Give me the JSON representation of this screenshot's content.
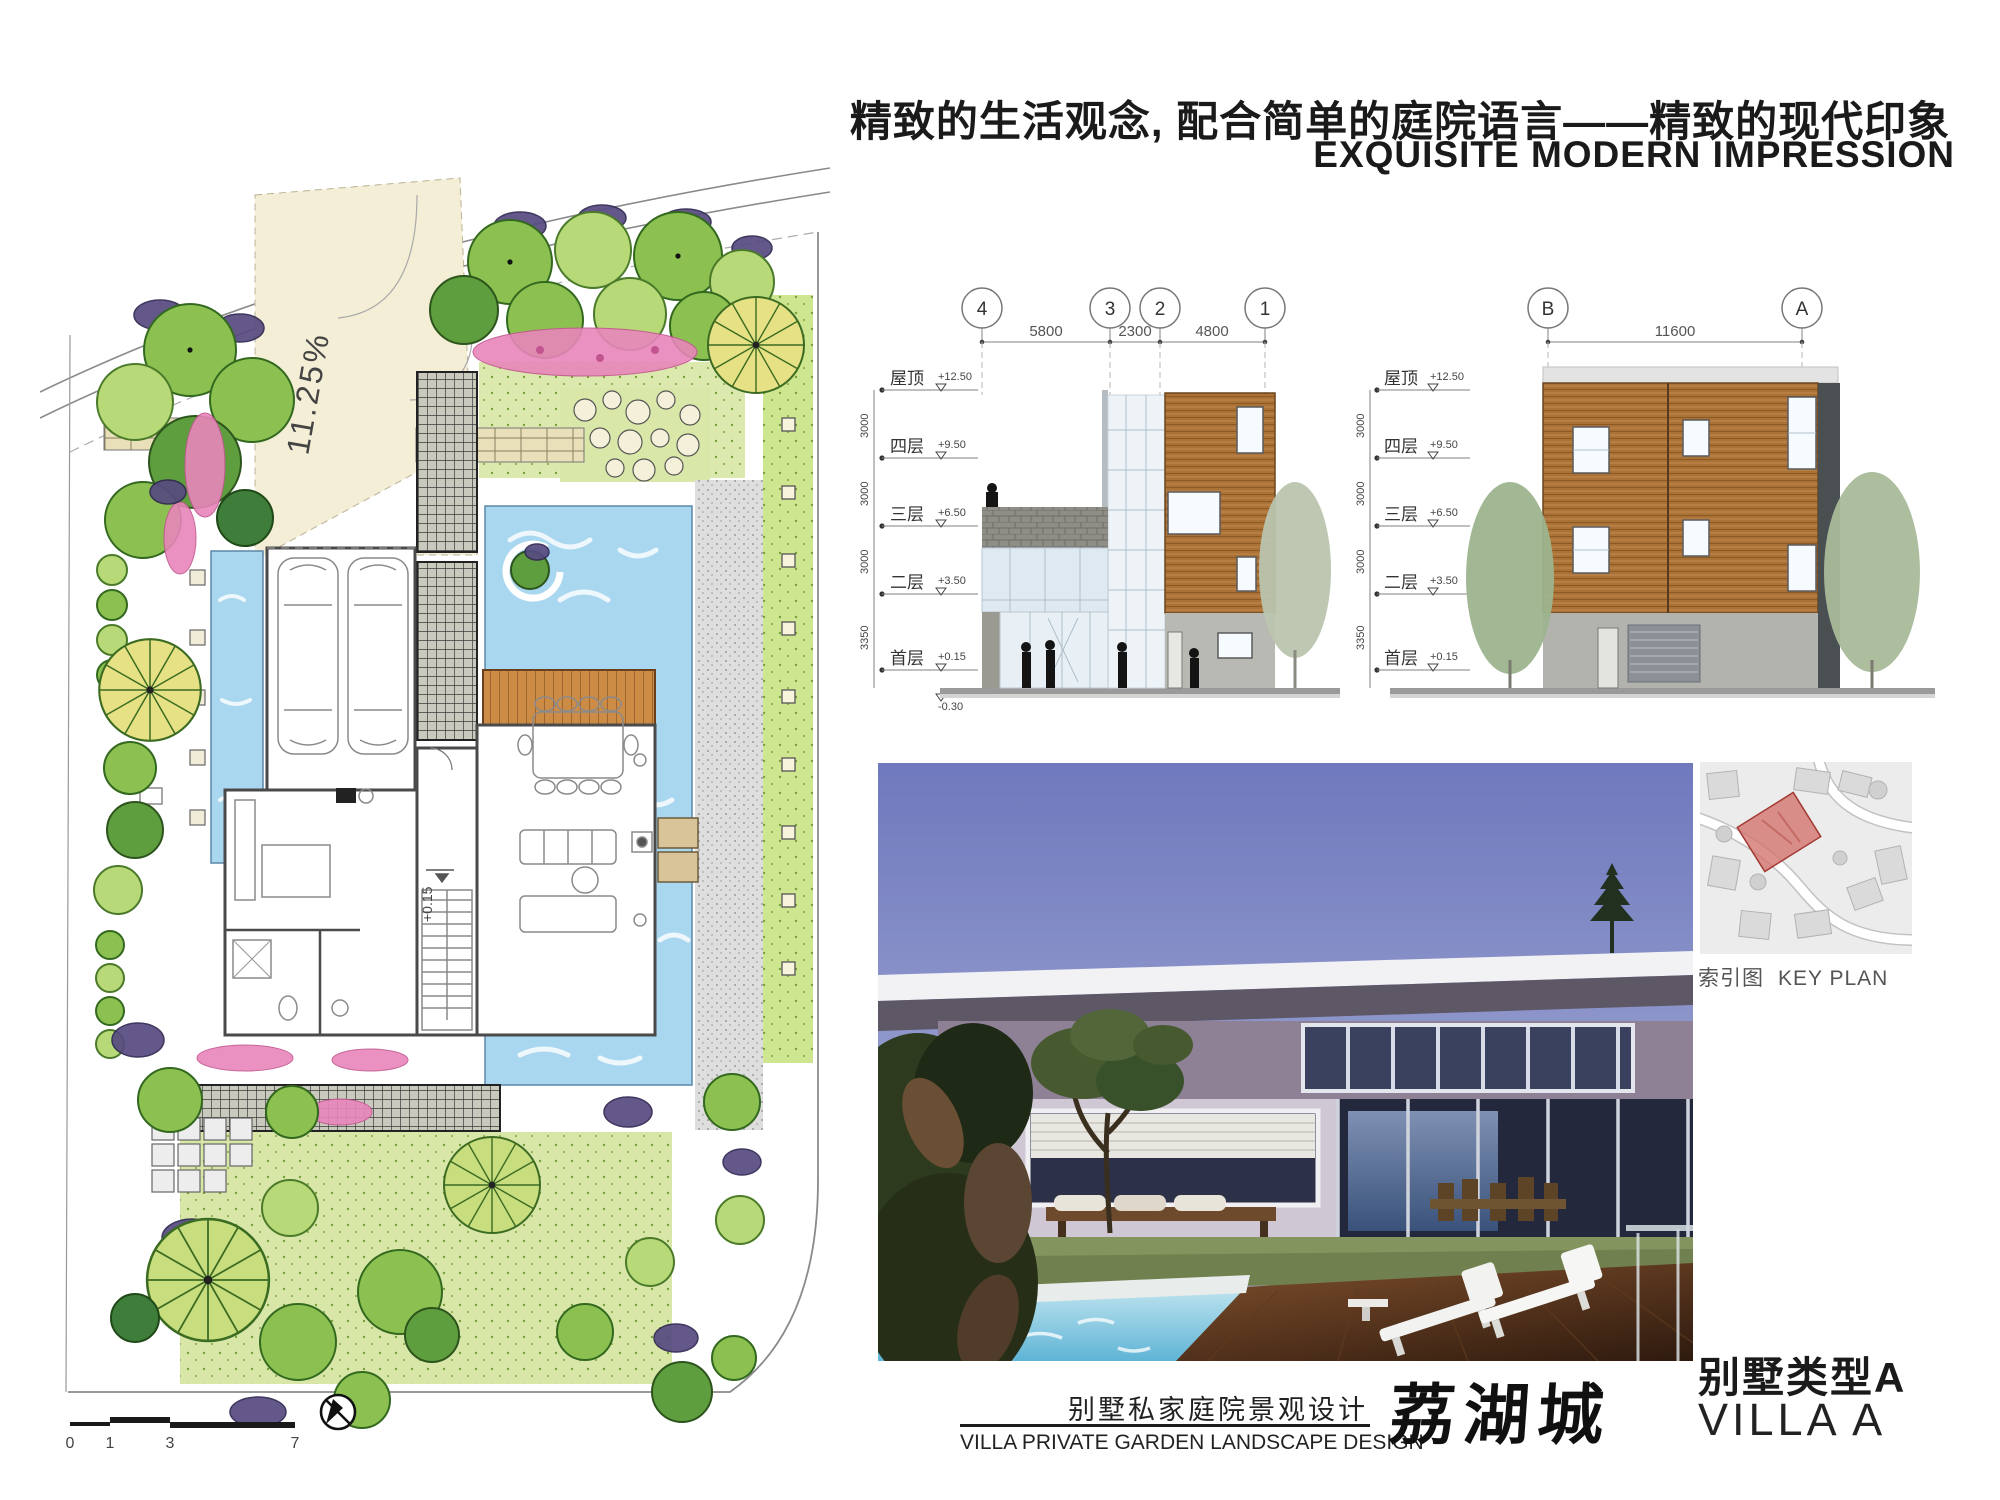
{
  "header": {
    "title_cn": "精致的生活观念, 配合简单的庭院语言——精致的现代印象",
    "title_en": "EXQUISITE MODERN IMPRESSION"
  },
  "site_plan": {
    "slope_label": "11.25%",
    "level_label": "+0.15",
    "scale_ticks": [
      "0",
      "1",
      "3",
      "7"
    ]
  },
  "elevations": {
    "floors": [
      {
        "label": "屋顶",
        "level": "+12.50"
      },
      {
        "label": "四层",
        "level": "+9.50"
      },
      {
        "label": "三层",
        "level": "+6.50"
      },
      {
        "label": "二层",
        "level": "+3.50"
      },
      {
        "label": "首层",
        "level": "+0.15"
      }
    ],
    "ground_level": "-0.30",
    "storey_heights": [
      "3000",
      "3000",
      "3000",
      "3350"
    ],
    "south_elevation": {
      "grids": [
        "4",
        "3",
        "2",
        "1"
      ],
      "spans": [
        "5800",
        "2300",
        "4800"
      ]
    },
    "side_elevation": {
      "grids": [
        "B",
        "A"
      ],
      "spans": [
        "11600"
      ]
    }
  },
  "key_plan": {
    "label_cn": "索引图",
    "label_en": "KEY PLAN"
  },
  "footer": {
    "project_cn": "别墅私家庭院景观设计",
    "project_en": "VILLA  PRIVATE GARDEN LANDSCAPE DESIGN",
    "brand": "荔湖城",
    "villa_type_cn": "别墅类型A",
    "villa_type_en": "VILLA  A"
  },
  "colors": {
    "water": "#a9d7ef",
    "wood": "#a9672f",
    "foliage": "#8cc152",
    "plot_highlight": "#d4726c"
  }
}
